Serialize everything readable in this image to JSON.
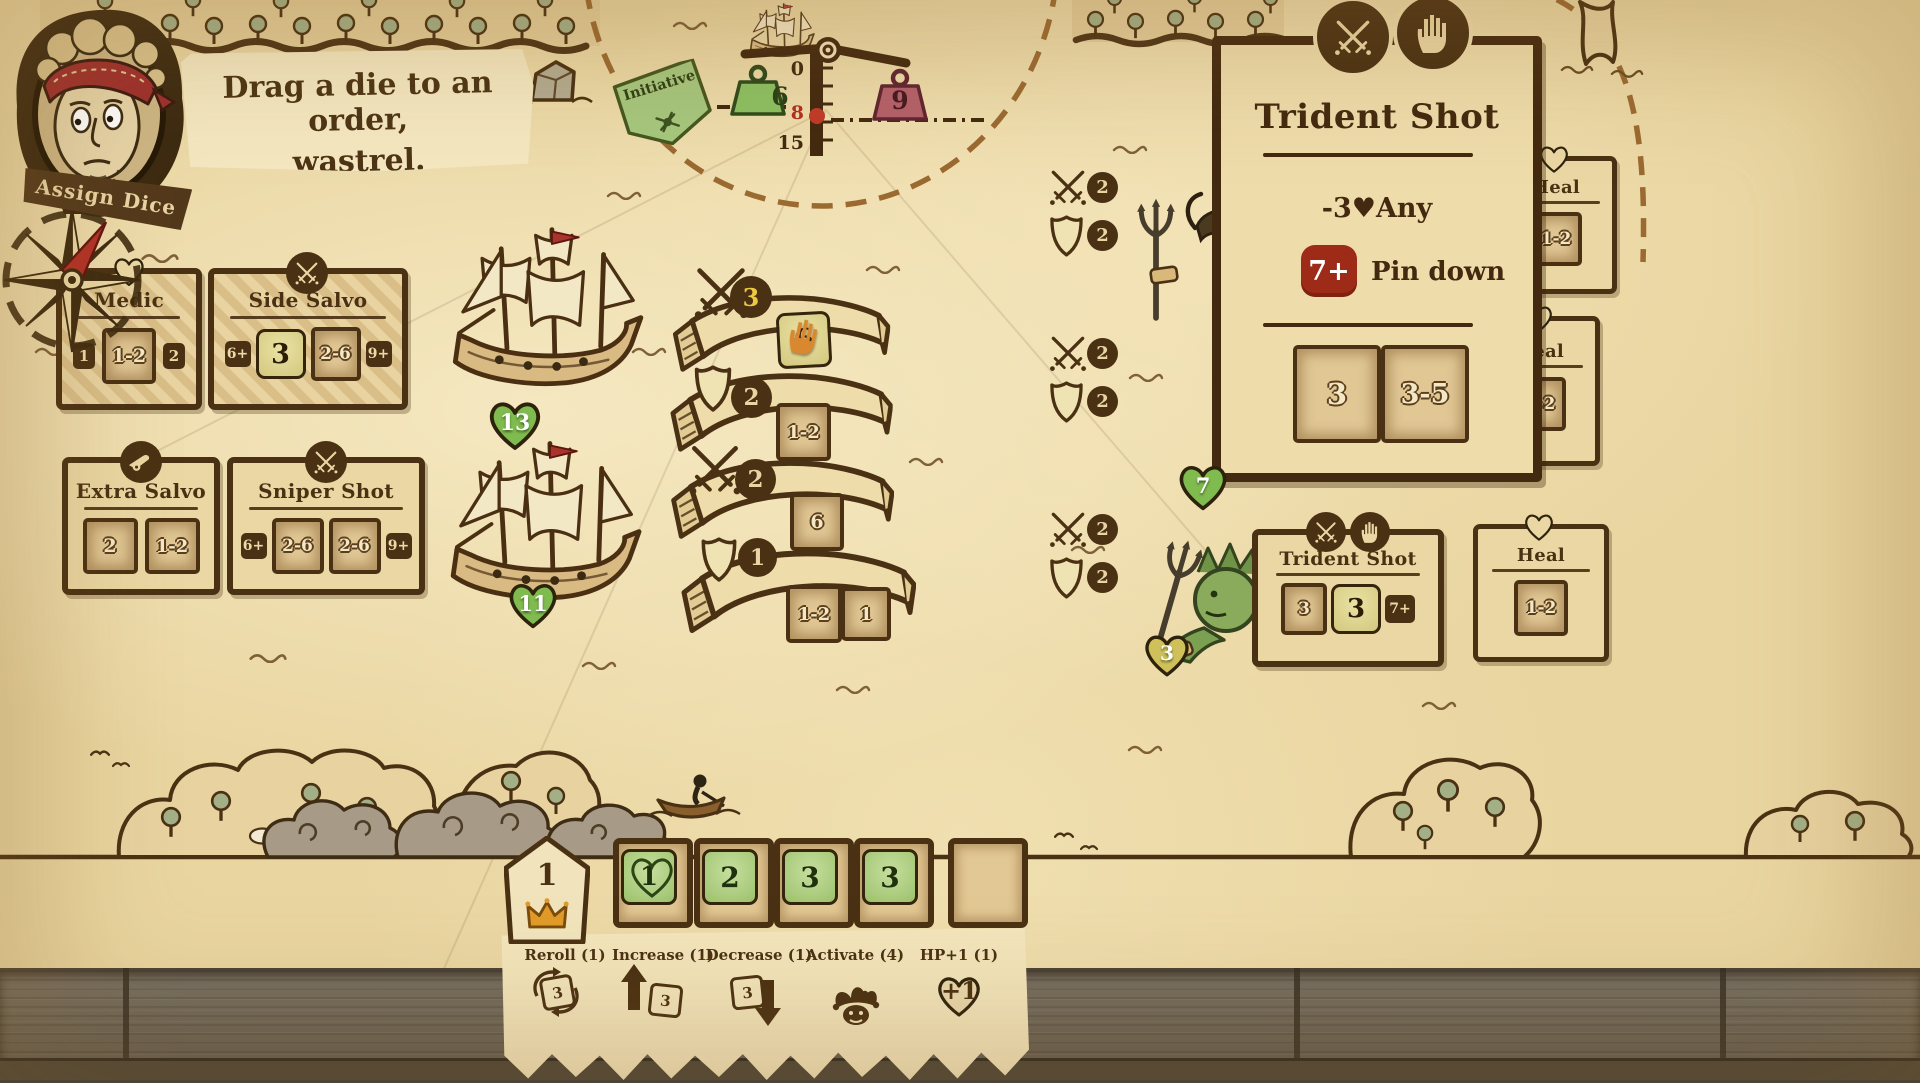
{
  "assistant": {
    "label": "Assign Dice",
    "message_line1": "Drag a die to an order,",
    "message_line2": "wastrel."
  },
  "initiative": {
    "label": "Initiative"
  },
  "scale": {
    "left_weight": "6",
    "right_weight": "9",
    "tick_top": "0",
    "tick_mid": "8",
    "tick_bottom": "15"
  },
  "orders": {
    "medic": {
      "title": "Medic",
      "badge_left": "1",
      "slot": "1-2",
      "badge_right": "2"
    },
    "side_salvo": {
      "title": "Side Salvo",
      "badge_left": "6+",
      "die": "3",
      "slot": "2-6",
      "badge_right": "9+"
    },
    "extra_salvo": {
      "title": "Extra Salvo",
      "slot1": "2",
      "slot2": "1-2"
    },
    "sniper_shot": {
      "title": "Sniper Shot",
      "badge_left": "6+",
      "slot1": "2-6",
      "slot2": "2-6",
      "badge_right": "9+"
    }
  },
  "ships": {
    "ship1_hp": "13",
    "ship2_hp": "11"
  },
  "banners": {
    "b1": {
      "count": "3",
      "die": "6"
    },
    "b2": {
      "count": "2",
      "slot": "1-2"
    },
    "b3": {
      "count": "2",
      "slot": "6"
    },
    "b4": {
      "count": "1",
      "slot1": "1-2",
      "slot2": "1"
    }
  },
  "enemies": {
    "stats": [
      {
        "attack": "2",
        "defense": "2"
      },
      {
        "attack": "2",
        "defense": "2"
      },
      {
        "attack": "2",
        "defense": "2"
      }
    ],
    "heart_mid": "7",
    "heart_bottom": "3"
  },
  "detail_card": {
    "title": "Trident Shot",
    "effect": "-3♥Any",
    "threshold": "7+",
    "threshold_text": "Pin down",
    "slot1": "3",
    "slot2": "3-5"
  },
  "trident_card": {
    "title": "Trident Shot",
    "slot": "3",
    "die": "3",
    "badge": "7+"
  },
  "heal_cards": {
    "top": {
      "title": "Heal",
      "slot": "1-2"
    },
    "middle": {
      "title": "Heal",
      "slot": "1-2"
    },
    "bottom": {
      "title": "Heal",
      "slot": "1-2"
    }
  },
  "turn_marker": {
    "value": "1"
  },
  "dice_tray": {
    "die1": "1",
    "die2": "2",
    "die3": "3",
    "die4": "3"
  },
  "actions": {
    "reroll": {
      "label": "Reroll (1)",
      "die": "3"
    },
    "increase": {
      "label": "Increase (1)",
      "die": "3"
    },
    "decrease": {
      "label": "Decrease (1)",
      "die": "3"
    },
    "activate": {
      "label": "Activate (4)"
    },
    "hp": {
      "label": "HP+1 (1)",
      "value": "+1"
    }
  },
  "colors": {
    "parchment": "#e9d5a0",
    "ink": "#4a3113",
    "accent_red": "#9e2b17",
    "die_yellow": "#d9d08a",
    "die_green": "#a5c877",
    "heart_green": "#7fbb4e",
    "pennant_green": "#a6c77e",
    "weight_green": "#8cc063",
    "weight_red": "#b4606b"
  }
}
